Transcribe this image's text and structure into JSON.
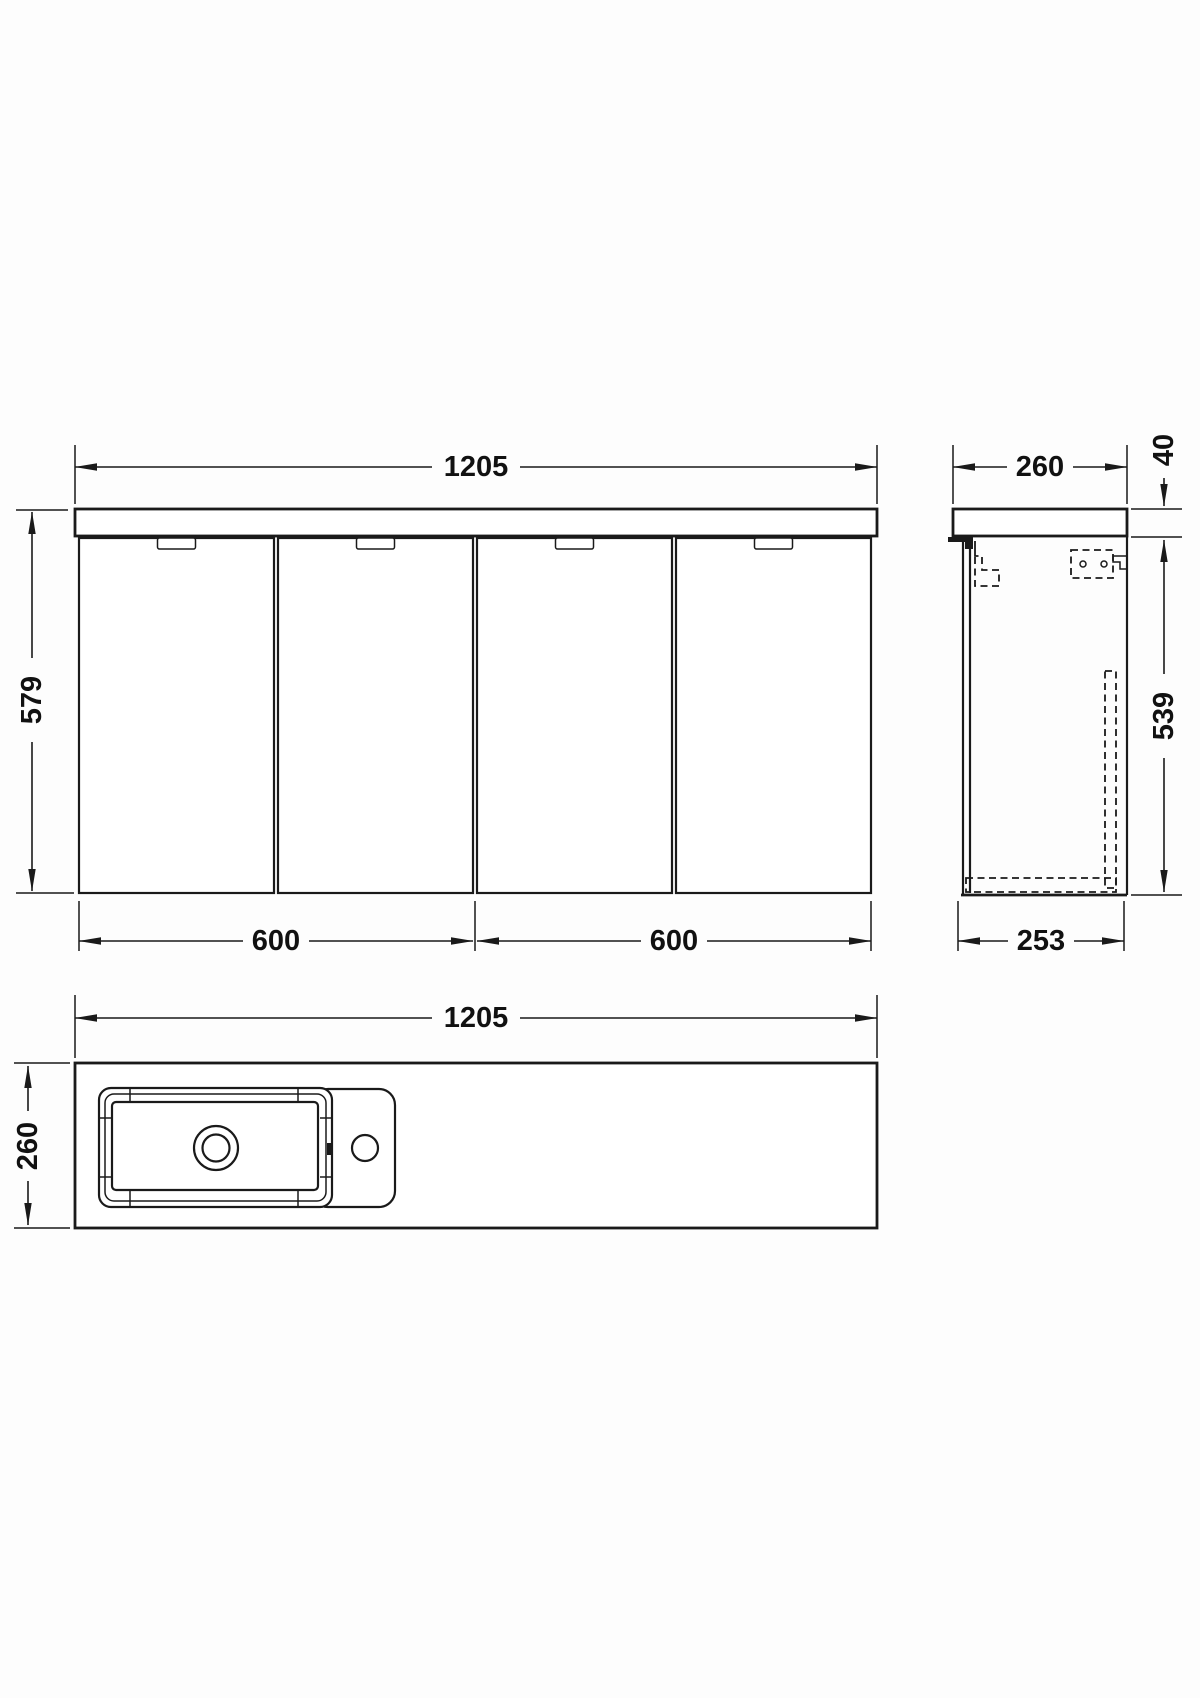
{
  "drawing": {
    "colors": {
      "line": "#1a1a1a",
      "background": "#fdfdfd"
    },
    "front_view": {
      "dims": {
        "overall_width": "1205",
        "overall_height": "579",
        "left_cabinet_width": "600",
        "right_cabinet_width": "600"
      }
    },
    "side_view": {
      "dims": {
        "overall_depth": "260",
        "worktop_thickness": "40",
        "cabinet_height": "539",
        "cabinet_depth": "253"
      }
    },
    "plan_view": {
      "dims": {
        "overall_width": "1205",
        "overall_depth": "260"
      }
    }
  }
}
